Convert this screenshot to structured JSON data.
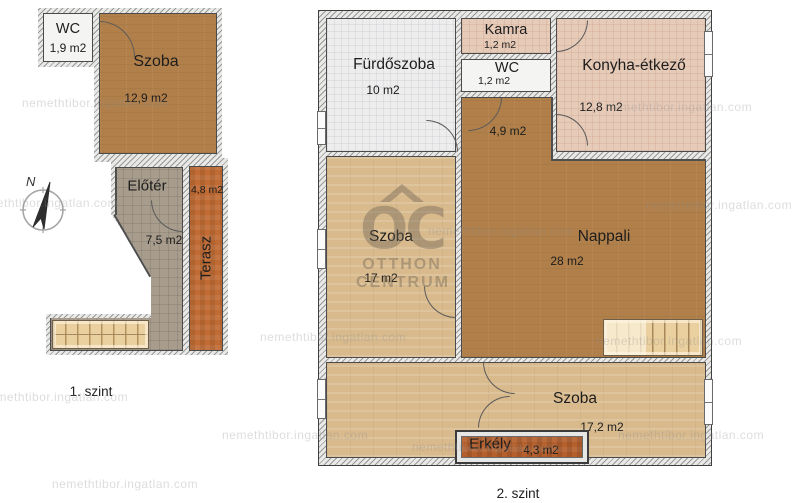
{
  "watermark": {
    "tile": "nemethtibor.ingatlan.com"
  },
  "brand": {
    "initials": "OC",
    "line1": "OTTHON",
    "line2": "CENTRUM"
  },
  "compass": {
    "north": "N"
  },
  "colors": {
    "room_brown": "#b1804a",
    "room_tan": "#d9ba8d",
    "room_gray": "#a89d8d",
    "room_pink": "#e7cbb9",
    "terrace_orange": "#bf6b33",
    "balcony_orange": "#b5602c",
    "wall_hatch": "#e9e9e7"
  },
  "floor1": {
    "label": "1. szint",
    "rooms": {
      "wc": {
        "name": "WC",
        "area": "1,9 m2"
      },
      "szoba": {
        "name": "Szoba",
        "area": "12,9 m2"
      },
      "eloter": {
        "name": "Előtér",
        "area": "7,5 m2"
      },
      "terasz": {
        "name": "Terasz",
        "area": "4,8 m2"
      }
    }
  },
  "floor2": {
    "label": "2. szint",
    "rooms": {
      "furdoszoba": {
        "name": "Fürdőszoba",
        "area": "10 m2"
      },
      "kamra": {
        "name": "Kamra",
        "area": "1,2 m2"
      },
      "wc": {
        "name": "WC",
        "area": "1,2 m2"
      },
      "konyha": {
        "name": "Konyha-étkező",
        "area": "12,8 m2"
      },
      "kozlekedo": {
        "area": "4,9 m2"
      },
      "szoba1": {
        "name": "Szoba",
        "area": "17 m2"
      },
      "nappali": {
        "name": "Nappali",
        "area": "28 m2"
      },
      "szoba2": {
        "name": "Szoba",
        "area": "17,2 m2"
      },
      "erkely": {
        "name": "Erkély",
        "area": "4,3 m2"
      }
    }
  }
}
